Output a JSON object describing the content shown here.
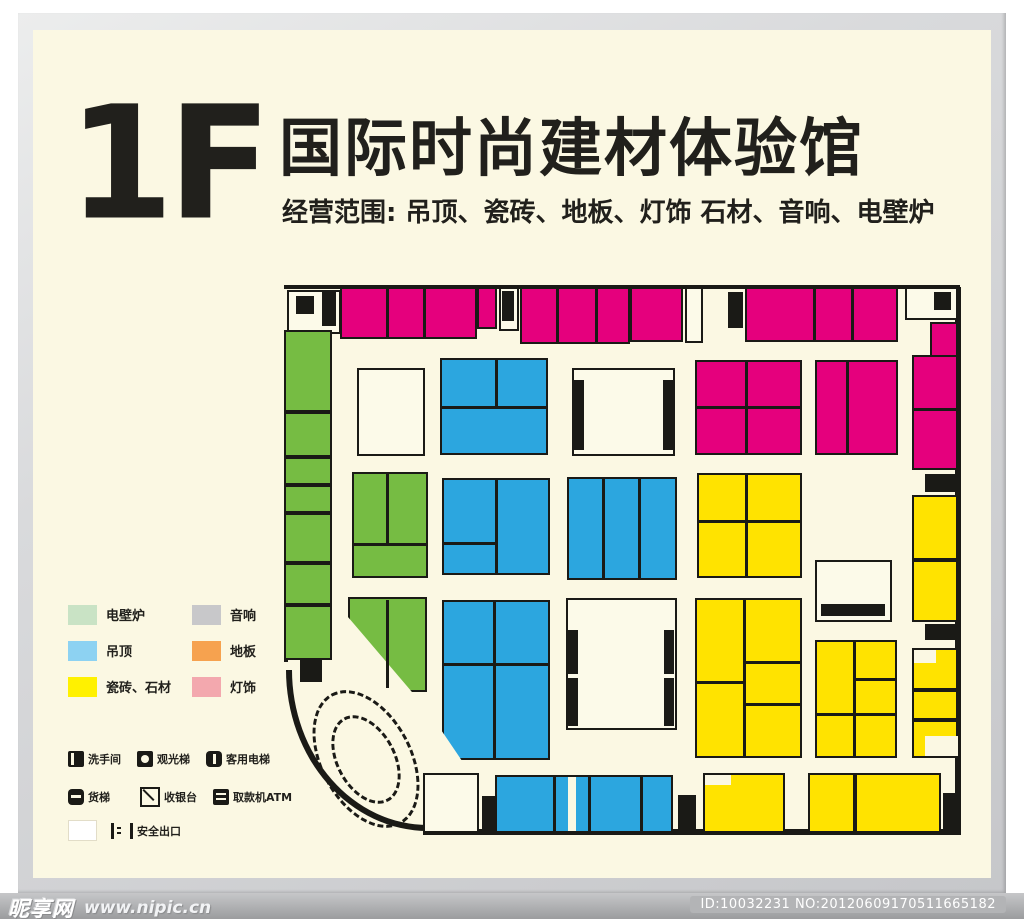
{
  "header": {
    "floor": "1F",
    "title": "国际时尚建材体验馆",
    "subtitle": "经营范围: 吊顶、瓷砖、地板、灯饰 石材、音响、电壁炉"
  },
  "legend": {
    "columns": [
      [
        {
          "label": "电壁炉",
          "color": "#C9E3C5"
        },
        {
          "label": "吊顶",
          "color": "#8DD2F2"
        },
        {
          "label": "瓷砖、石材",
          "color": "#FFF100"
        }
      ],
      [
        {
          "label": "音响",
          "color": "#C8C8CA"
        },
        {
          "label": "地板",
          "color": "#F6A24F"
        },
        {
          "label": "灯饰",
          "color": "#F3A8AE"
        }
      ]
    ]
  },
  "facilities": {
    "rows": [
      [
        {
          "icon": "restroom-icon",
          "label": "洗手间"
        },
        {
          "icon": "observation-elevator-icon",
          "label": "观光梯"
        },
        {
          "icon": "passenger-elevator-icon",
          "label": "客用电梯"
        }
      ],
      [
        {
          "icon": "freight-elevator-icon",
          "label": "货梯"
        },
        {
          "icon": "cashier-icon",
          "label": "收银台"
        },
        {
          "icon": "atm-icon",
          "label": "取款机ATM"
        }
      ],
      [
        {
          "icon": "stairs-icon",
          "label": "安全出口"
        }
      ]
    ]
  },
  "watermark": {
    "site_name": "昵享网",
    "site_url": "www.nipic.cn",
    "id_text": "ID:10032231 NO:20120609170511665182"
  },
  "plan": {
    "width": 678,
    "height": 558,
    "colors": {
      "M": "#E5007D",
      "B": "#2CA6DF",
      "G": "#76BC43",
      "Y": "#FFE300",
      "W": "#FCFAE9",
      "K": "#1A1A16",
      "X": "#FBF8E3"
    },
    "elements": [
      [
        "line",
        0,
        3,
        676,
        4
      ],
      [
        "line",
        671,
        5,
        6,
        548
      ],
      [
        "line",
        139,
        547,
        537,
        6
      ],
      [
        "line",
        0,
        48,
        4,
        332
      ],
      [
        "arc",
        2,
        388,
        142,
        161
      ],
      [
        "rect",
        3,
        8,
        54,
        44,
        "W",
        1
      ],
      [
        "rect",
        12,
        14,
        18,
        18,
        "K",
        0
      ],
      [
        "rect",
        38,
        10,
        14,
        34,
        "K",
        0
      ],
      [
        "rect",
        56,
        5,
        137,
        52,
        "M",
        1
      ],
      [
        "line",
        102,
        5,
        3,
        52
      ],
      [
        "line",
        139,
        5,
        3,
        52
      ],
      [
        "rect",
        193,
        5,
        20,
        42,
        "M",
        1
      ],
      [
        "rect",
        215,
        5,
        20,
        44,
        "W",
        1
      ],
      [
        "rect",
        218,
        9,
        12,
        30,
        "K",
        0
      ],
      [
        "rect",
        236,
        5,
        110,
        57,
        "M",
        1
      ],
      [
        "line",
        272,
        5,
        3,
        57
      ],
      [
        "line",
        311,
        5,
        3,
        57
      ],
      [
        "rect",
        346,
        5,
        53,
        55,
        "M",
        1
      ],
      [
        "rect",
        401,
        5,
        18,
        56,
        "W",
        1
      ],
      [
        "rect",
        444,
        10,
        15,
        36,
        "K",
        0
      ],
      [
        "rect",
        461,
        5,
        153,
        55,
        "M",
        1
      ],
      [
        "line",
        529,
        5,
        3,
        55
      ],
      [
        "line",
        567,
        5,
        3,
        55
      ],
      [
        "rect",
        621,
        5,
        53,
        33,
        "W",
        1
      ],
      [
        "rect",
        650,
        10,
        17,
        18,
        "K",
        0
      ],
      [
        "rect",
        0,
        48,
        48,
        82,
        "G",
        1
      ],
      [
        "rect",
        0,
        130,
        48,
        45,
        "G",
        1
      ],
      [
        "rect",
        0,
        175,
        48,
        28,
        "G",
        1
      ],
      [
        "rect",
        0,
        203,
        48,
        28,
        "G",
        1
      ],
      [
        "rect",
        0,
        231,
        48,
        50,
        "G",
        1
      ],
      [
        "rect",
        0,
        281,
        48,
        42,
        "G",
        1
      ],
      [
        "rect",
        0,
        323,
        48,
        55,
        "G",
        1
      ],
      [
        "rect",
        16,
        378,
        22,
        22,
        "K",
        0
      ],
      [
        "rect",
        73,
        86,
        68,
        88,
        "W",
        1
      ],
      [
        "rect",
        68,
        190,
        76,
        106,
        "G",
        1
      ],
      [
        "line",
        102,
        190,
        3,
        73
      ],
      [
        "line",
        68,
        261,
        76,
        3
      ],
      [
        "poly",
        64,
        315,
        79,
        95,
        "G",
        "polygon(0 0,100% 0,100% 100%,81% 100%,0 21%)"
      ],
      [
        "line",
        102,
        318,
        3,
        88
      ],
      [
        "rect",
        156,
        76,
        108,
        97,
        "B",
        1
      ],
      [
        "line",
        211,
        76,
        3,
        50
      ],
      [
        "line",
        156,
        124,
        108,
        3
      ],
      [
        "rect",
        158,
        196,
        108,
        97,
        "B",
        1
      ],
      [
        "line",
        211,
        196,
        3,
        97
      ],
      [
        "line",
        158,
        260,
        55,
        3
      ],
      [
        "poly",
        158,
        318,
        108,
        160,
        "B",
        "polygon(0 0,100% 0,100% 100%,18% 100%,0 82%)"
      ],
      [
        "line",
        209,
        318,
        3,
        160
      ],
      [
        "line",
        158,
        381,
        108,
        3
      ],
      [
        "rect",
        288,
        86,
        103,
        88,
        "W",
        1
      ],
      [
        "rect",
        290,
        98,
        10,
        70,
        "K",
        0
      ],
      [
        "rect",
        379,
        98,
        10,
        70,
        "K",
        0
      ],
      [
        "rect",
        283,
        195,
        110,
        103,
        "B",
        1
      ],
      [
        "line",
        318,
        195,
        3,
        103
      ],
      [
        "line",
        354,
        195,
        3,
        103
      ],
      [
        "rect",
        282,
        316,
        111,
        132,
        "W",
        1
      ],
      [
        "rect",
        284,
        348,
        10,
        44,
        "K",
        0
      ],
      [
        "rect",
        284,
        396,
        10,
        48,
        "K",
        0
      ],
      [
        "rect",
        380,
        348,
        10,
        44,
        "K",
        0
      ],
      [
        "rect",
        380,
        396,
        10,
        48,
        "K",
        0
      ],
      [
        "rect",
        411,
        78,
        107,
        95,
        "M",
        1
      ],
      [
        "line",
        461,
        78,
        3,
        95
      ],
      [
        "line",
        411,
        124,
        107,
        3
      ],
      [
        "rect",
        531,
        78,
        83,
        95,
        "M",
        1
      ],
      [
        "line",
        562,
        78,
        3,
        95
      ],
      [
        "rect",
        646,
        40,
        28,
        35,
        "M",
        1
      ],
      [
        "rect",
        628,
        73,
        46,
        115,
        "M",
        1
      ],
      [
        "line",
        628,
        126,
        46,
        3
      ],
      [
        "rect",
        641,
        192,
        30,
        18,
        "K",
        0
      ],
      [
        "rect",
        628,
        213,
        46,
        65,
        "Y",
        1
      ],
      [
        "rect",
        628,
        278,
        46,
        62,
        "Y",
        1
      ],
      [
        "rect",
        641,
        342,
        30,
        16,
        "K",
        0
      ],
      [
        "rect",
        628,
        366,
        46,
        42,
        "Y",
        1
      ],
      [
        "rect",
        630,
        368,
        22,
        13,
        "X",
        0
      ],
      [
        "rect",
        628,
        408,
        46,
        30,
        "Y",
        1
      ],
      [
        "rect",
        628,
        438,
        46,
        38,
        "Y",
        1
      ],
      [
        "rect",
        641,
        454,
        33,
        20,
        "X",
        0
      ],
      [
        "rect",
        413,
        191,
        105,
        105,
        "Y",
        1
      ],
      [
        "line",
        461,
        191,
        3,
        105
      ],
      [
        "line",
        413,
        238,
        105,
        3
      ],
      [
        "rect",
        411,
        316,
        107,
        160,
        "Y",
        1
      ],
      [
        "line",
        459,
        316,
        3,
        160
      ],
      [
        "line",
        462,
        379,
        56,
        3
      ],
      [
        "line",
        462,
        421,
        56,
        3
      ],
      [
        "line",
        411,
        399,
        48,
        3
      ],
      [
        "rect",
        531,
        358,
        82,
        118,
        "Y",
        1
      ],
      [
        "line",
        569,
        358,
        3,
        118
      ],
      [
        "line",
        572,
        396,
        41,
        3
      ],
      [
        "line",
        531,
        431,
        82,
        3
      ],
      [
        "rect",
        531,
        278,
        77,
        62,
        "W",
        1
      ],
      [
        "rect",
        537,
        322,
        64,
        12,
        "K",
        0
      ],
      [
        "rect",
        139,
        491,
        56,
        60,
        "W",
        1
      ],
      [
        "rect",
        198,
        514,
        18,
        34,
        "K",
        0
      ],
      [
        "rect",
        211,
        493,
        178,
        58,
        "B",
        1
      ],
      [
        "line",
        269,
        493,
        3,
        58
      ],
      [
        "rect",
        284,
        495,
        8,
        54,
        "X",
        0
      ],
      [
        "line",
        304,
        493,
        3,
        58
      ],
      [
        "line",
        356,
        493,
        3,
        58
      ],
      [
        "rect",
        394,
        513,
        18,
        36,
        "K",
        0
      ],
      [
        "rect",
        419,
        491,
        82,
        60,
        "Y",
        1
      ],
      [
        "rect",
        421,
        493,
        26,
        10,
        "X",
        0
      ],
      [
        "rect",
        524,
        491,
        47,
        60,
        "Y",
        1
      ],
      [
        "rect",
        571,
        491,
        86,
        60,
        "Y",
        1
      ],
      [
        "rect",
        659,
        511,
        16,
        40,
        "K",
        0
      ],
      [
        "ell",
        36,
        403,
        92,
        148,
        -28
      ],
      [
        "ell",
        52,
        430,
        60,
        95,
        -28
      ]
    ]
  }
}
